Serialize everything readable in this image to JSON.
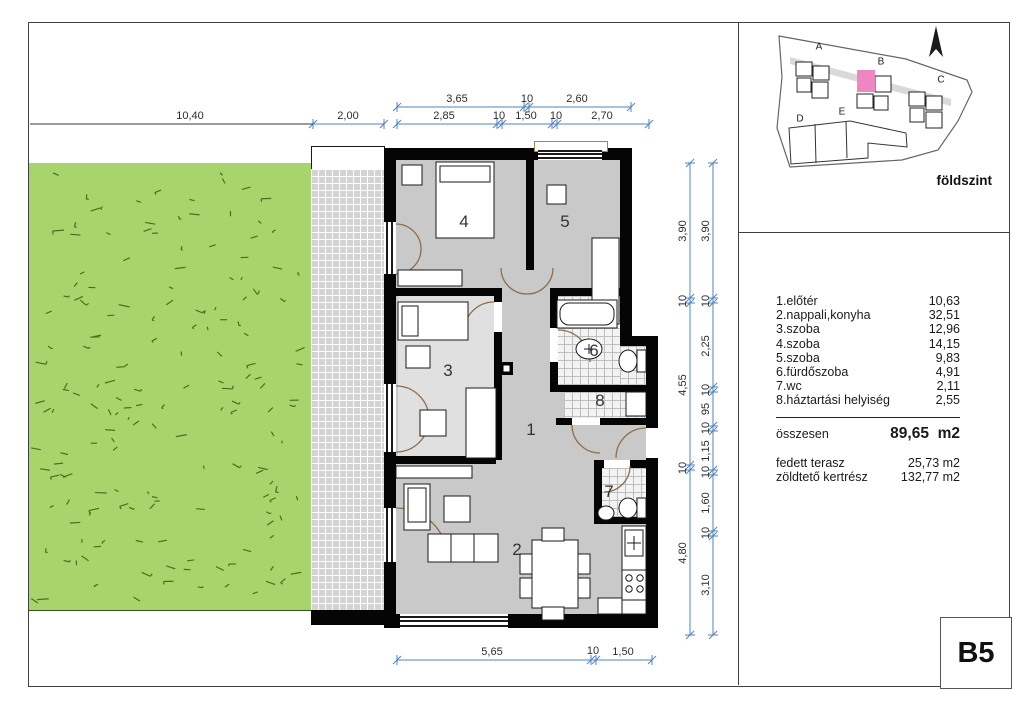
{
  "floor_plan": {
    "room_labels": [
      "1",
      "2",
      "3",
      "4",
      "5",
      "6",
      "7",
      "8"
    ]
  },
  "dimensions": {
    "top_row1": [
      "3,65",
      "10",
      "2,60"
    ],
    "top_row2": [
      "2,85",
      "10",
      "1,50",
      "10",
      "2,70"
    ],
    "left": [
      "10,40",
      "2,00"
    ],
    "right_inner": [
      "3,90",
      "10",
      "4,55",
      "10",
      "4,80"
    ],
    "right_outer": [
      "3,90",
      "10",
      "2,25",
      "10",
      "95",
      "10",
      "1,15",
      "10",
      "1,60",
      "10",
      "3,10"
    ],
    "bottom": [
      "5,65",
      "10",
      "1,50"
    ]
  },
  "site_plan": {
    "labels": [
      "A",
      "B",
      "C",
      "D",
      "E"
    ],
    "floor_label": "földszint",
    "highlight_color": "#ee86c1"
  },
  "legend": {
    "rows": [
      {
        "label": "1.előtér",
        "value": "10,63"
      },
      {
        "label": "2.nappali,konyha",
        "value": "32,51"
      },
      {
        "label": "3.szoba",
        "value": "12,96"
      },
      {
        "label": "4.szoba",
        "value": "14,15"
      },
      {
        "label": "5.szoba",
        "value": "9,83"
      },
      {
        "label": "6.fürdőszoba",
        "value": "4,91"
      },
      {
        "label": "7.wc",
        "value": "2,11"
      },
      {
        "label": "8.háztartási helyiség",
        "value": "2,55"
      }
    ],
    "total_label": "összesen",
    "total_value": "89,65",
    "total_unit": "m2",
    "extras": [
      {
        "label": "fedett terasz",
        "value": "25,73 m2"
      },
      {
        "label": "zöldtető kertrész",
        "value": "132,77 m2"
      }
    ]
  },
  "title_block": {
    "unit": "B5"
  },
  "colors": {
    "garden": "#a8d56b",
    "floor_gray": "#c9c9c9",
    "dimension_blue": "#4c84c0",
    "door_brown": "#8c6f4b",
    "highlight_pink": "#ee86c1"
  }
}
